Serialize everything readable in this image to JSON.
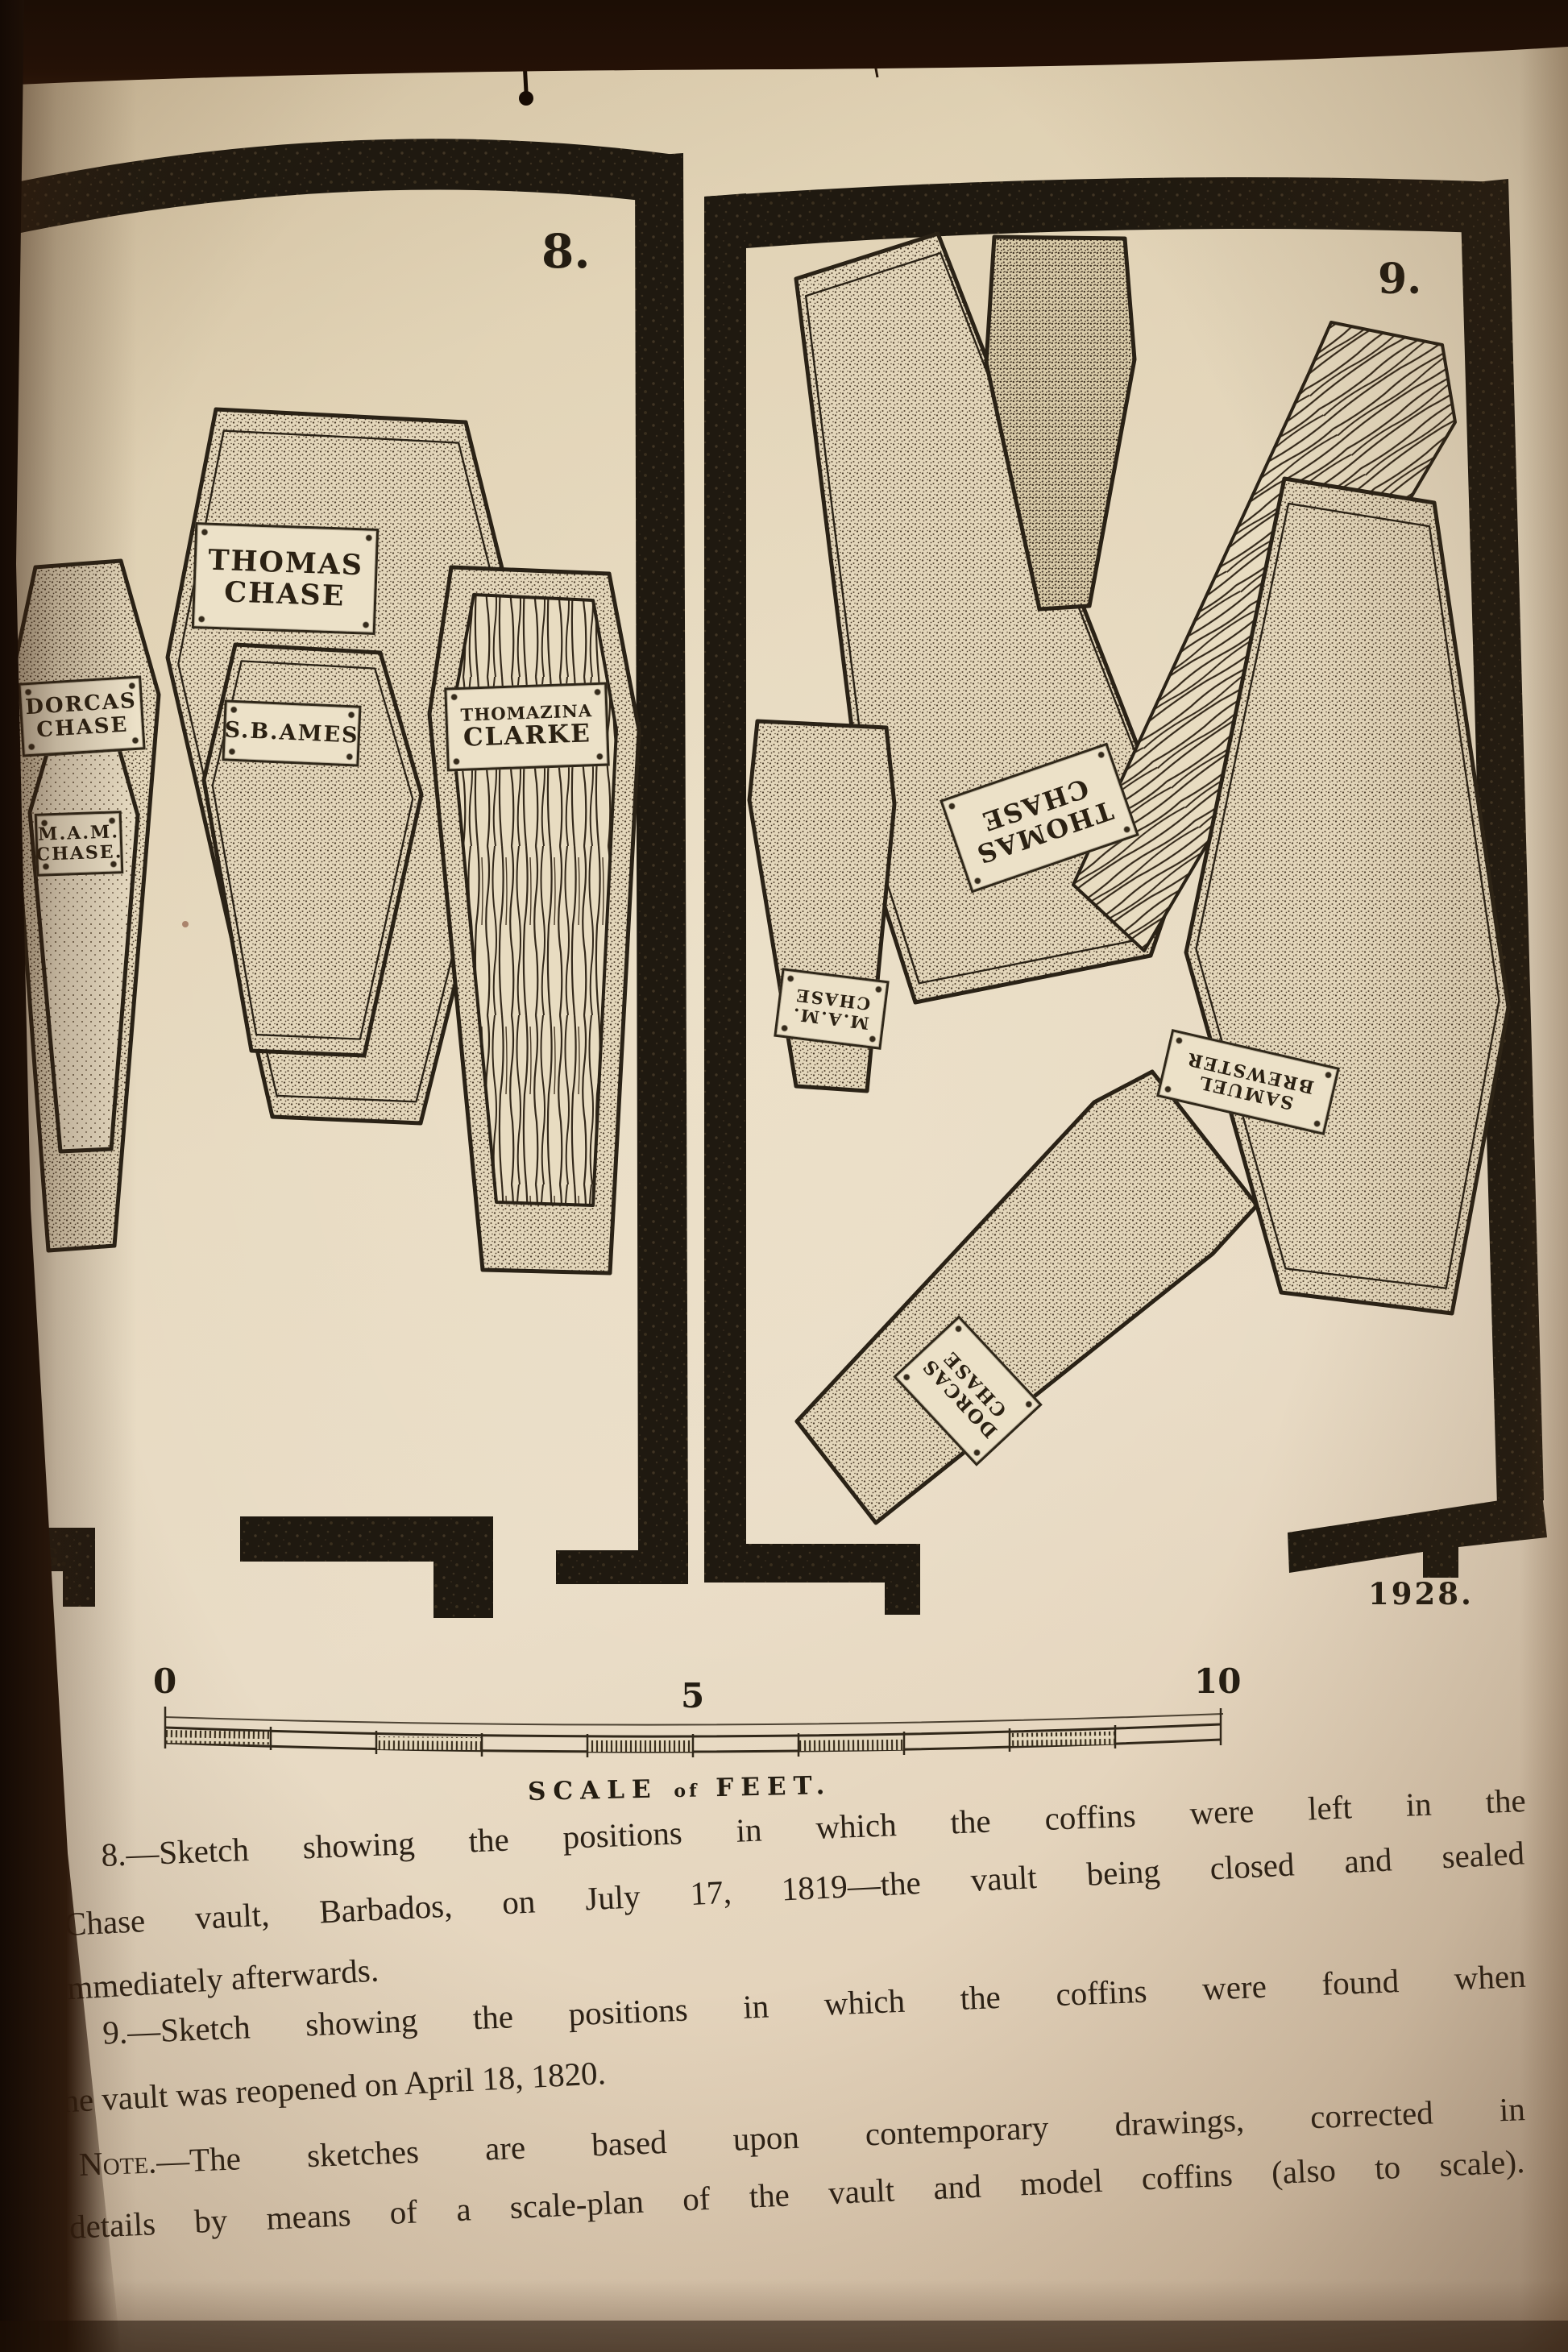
{
  "page": {
    "figure8": {
      "number": "8.",
      "coffin_plates": {
        "dorcas": {
          "line1": "DORCAS",
          "line2": "CHASE"
        },
        "mam": {
          "line1": "M.A.M.",
          "line2": "CHASE."
        },
        "thomas": {
          "line1": "THOMAS",
          "line2": "CHASE"
        },
        "sb_ames": {
          "line1": "S.B.AMES"
        },
        "thomazina": {
          "line1": "THOMAZINA",
          "line2": "CLARKE"
        }
      }
    },
    "figure9": {
      "number": "9.",
      "year_mark": "1928.",
      "coffin_plates": {
        "thomas": {
          "line1": "THOMAS",
          "line2": "CHASE"
        },
        "mam": {
          "line1": "M.A.M.",
          "line2": "CHASE"
        },
        "brewster": {
          "line1": "SAMUEL",
          "line2": "BREWSTER"
        },
        "dorcas": {
          "line1": "DORCAS",
          "line2": "CHASE"
        }
      }
    },
    "artist_initials": "I.T.G.",
    "scale_bar": {
      "tick_0": "0",
      "tick_5": "5",
      "tick_10": "10",
      "caption_word1": "SCALE",
      "caption_word2": "of",
      "caption_word3": "FEET."
    },
    "captions": {
      "l1": {
        "lead": "Fig. 8.",
        "rest": "—Sketch showing the positions in which the coffins were left in the"
      },
      "l2": {
        "lead": "",
        "rest": "Chase vault, Barbados, on July 17, 1819—the vault being closed and sealed"
      },
      "l3": {
        "lead": "",
        "rest": "immediately afterwards."
      },
      "l4": {
        "lead": "Fig. 9.",
        "rest": "—Sketch showing the positions in which the coffins were found when"
      },
      "l5": {
        "lead": "",
        "rest": "the vault was reopened on April 18, 1820."
      },
      "l6": {
        "lead": "Note.",
        "rest": "—The sketches are based upon contemporary drawings, corrected in"
      },
      "l7": {
        "lead": "",
        "rest": "details by means of a scale-plan of the vault and model coffins (also to scale)."
      }
    },
    "ink_color": "#2b2318",
    "paper_color": "#e6d9c0"
  }
}
